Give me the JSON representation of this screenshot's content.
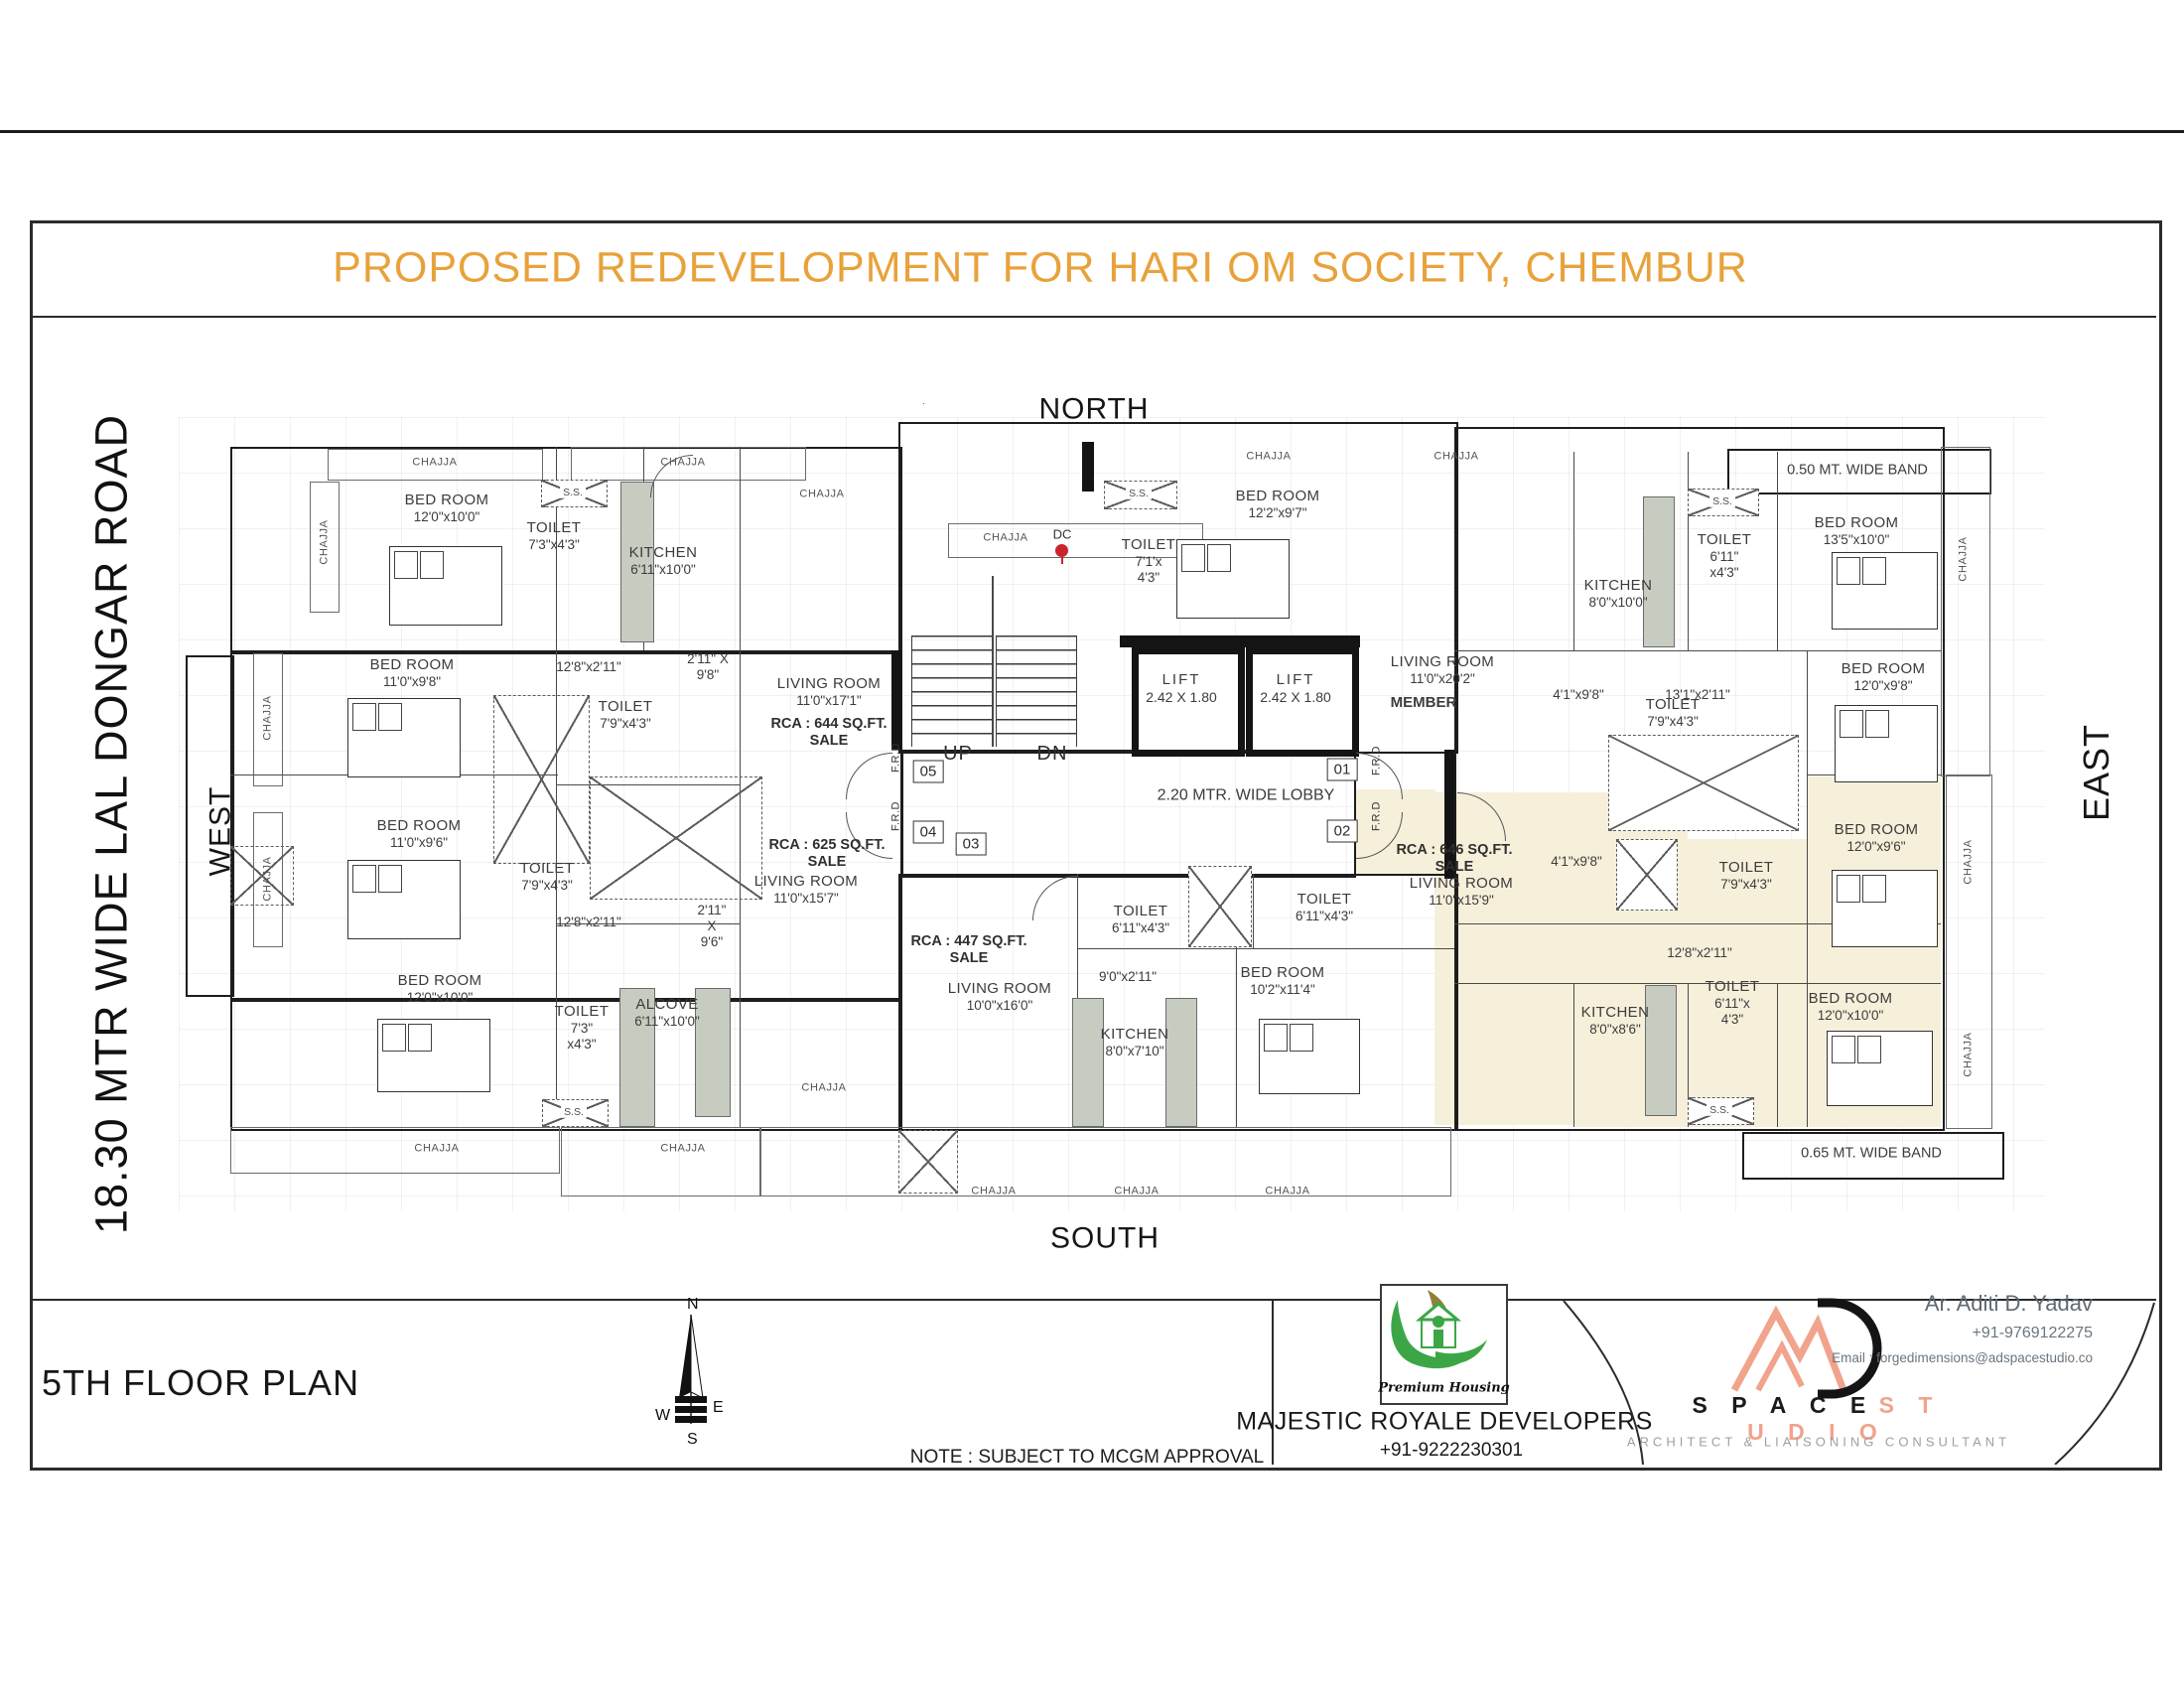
{
  "page": {
    "title": "PROPOSED REDEVELOPMENT FOR HARI OM SOCIETY, CHEMBUR",
    "floor_label": "5TH FLOOR PLAN",
    "note": "NOTE : SUBJECT TO MCGM APPROVAL"
  },
  "directions": {
    "north": "NORTH",
    "south": "SOUTH",
    "east": "EAST",
    "west": "WEST",
    "road": "18.30 MTR WIDE LAL DONGAR ROAD"
  },
  "compass": {
    "n": "N",
    "e": "E",
    "s": "S",
    "w": "W"
  },
  "plan": {
    "chajja": "CHAJJA",
    "ss": "S.S.",
    "frd": "F.R.D",
    "up": "UP",
    "dn": "DN",
    "member": "MEMBER",
    "dc": "DC",
    "lobby": "2.20 MTR. WIDE LOBBY",
    "lift": {
      "name": "LIFT",
      "size": "2.42 X 1.80"
    },
    "units": [
      "01",
      "02",
      "03",
      "04",
      "05"
    ],
    "bands": {
      "top": "0.50 MT. WIDE BAND",
      "bottom": "0.65 MT. WIDE BAND"
    },
    "rooms": [
      {
        "name": "BED ROOM",
        "dim": "12'0\"x10'0\""
      },
      {
        "name": "TOILET",
        "dim": "7'3\"x4'3\""
      },
      {
        "name": "KITCHEN",
        "dim": "6'11\"x10'0\""
      },
      {
        "name": "BED ROOM",
        "dim": "11'0\"x9'8\""
      },
      {
        "name": "TOILET",
        "dim": "7'9\"x4'3\""
      },
      {
        "name": "BED ROOM",
        "dim": "11'0\"x9'6\""
      },
      {
        "name": "TOILET",
        "dim": "7'9\"x4'3\""
      },
      {
        "name": "BED ROOM",
        "dim": "12'0\"x10'0\""
      },
      {
        "name": "TOILET",
        "dim": "7'3\"",
        "dim2": "x4'3\""
      },
      {
        "name": "ALCOVE",
        "dim": "6'11\"x10'0\""
      },
      {
        "name": "LIVING ROOM",
        "dim": "11'0\"x17'1\""
      },
      {
        "name": "LIVING ROOM",
        "dim": "11'0\"x15'7\""
      },
      {
        "name": "LIVING ROOM",
        "dim": "10'0\"x16'0\""
      },
      {
        "name": "KITCHEN",
        "dim": "8'0\"x7'10\""
      },
      {
        "name": "TOILET",
        "dim": "6'11\"x4'3\""
      },
      {
        "name": "TOILET",
        "dim": "6'11\"x4'3\""
      },
      {
        "name": "BED ROOM",
        "dim": "10'2\"x11'4\""
      },
      {
        "name": "TOILET",
        "dim": "7'1'x",
        "dim2": "4'3\""
      },
      {
        "name": "BED ROOM",
        "dim": "12'2\"x9'7\""
      },
      {
        "name": "LIVING ROOM",
        "dim": "11'0\"x20'2\""
      },
      {
        "name": "KITCHEN",
        "dim": "8'0\"x10'0\""
      },
      {
        "name": "TOILET",
        "dim": "6'11\"",
        "dim2": "x4'3\""
      },
      {
        "name": "BED ROOM",
        "dim": "13'5\"x10'0\""
      },
      {
        "name": "BED ROOM",
        "dim": "12'0\"x9'8\""
      },
      {
        "name": "LIVING ROOM",
        "dim": "11'0\"x15'9\""
      },
      {
        "name": "BED ROOM",
        "dim": "12'0\"x9'6\""
      },
      {
        "name": "TOILET",
        "dim": "7'9\"x4'3\""
      },
      {
        "name": "TOILET",
        "dim": "7'9\"x4'3\""
      },
      {
        "name": "KITCHEN",
        "dim": "8'0\"x8'6\""
      },
      {
        "name": "TOILET",
        "dim": "6'11\"x",
        "dim2": "4'3\""
      },
      {
        "name": "BED ROOM",
        "dim": "12'0\"x10'0\""
      }
    ],
    "rcas": [
      {
        "rca": "RCA : 644 SQ.FT.",
        "sale": "SALE"
      },
      {
        "rca": "RCA : 625 SQ.FT.",
        "sale": "SALE"
      },
      {
        "rca": "RCA : 447 SQ.FT.",
        "sale": "SALE"
      },
      {
        "rca": "RCA : 646 SQ.FT.",
        "sale": "SALE"
      }
    ],
    "dims": [
      {
        "t1": "12'8\"x2'11\""
      },
      {
        "t1": "2'11\" X",
        "t2": "9'8\""
      },
      {
        "t1": "12'8\"x2'11\""
      },
      {
        "t1": "2'11\"",
        "t2": "X",
        "t3": "9'6\""
      },
      {
        "t1": "4'1\"x9'8\""
      },
      {
        "t1": "13'1\"x2'11\""
      },
      {
        "t1": "4'1\"x9'8\""
      },
      {
        "t1": "12'8\"x2'11\""
      },
      {
        "t1": "9'0\"x2'11\""
      }
    ]
  },
  "developer": {
    "name": "MAJESTIC ROYALE DEVELOPERS",
    "tagline": "Premium Housing",
    "phone": "+91-9222230301"
  },
  "studio": {
    "name_black": "S P A C E",
    "name_accent": "S T U D I O",
    "subtitle": "ARCHITECT  &  LIAISONING  CONSULTANT",
    "person": "Ar. Aditi D. Yadav",
    "phone": "+91-9769122275",
    "email": "Email : forgedimensions@adspacestudio.co"
  },
  "colors": {
    "accent_orange": "#E8A23B",
    "studio_salmon": "#F1A38C",
    "developer_green": "#3CA646",
    "highlight_beige": "#F6EFDA",
    "dc_red": "#C9252B"
  }
}
